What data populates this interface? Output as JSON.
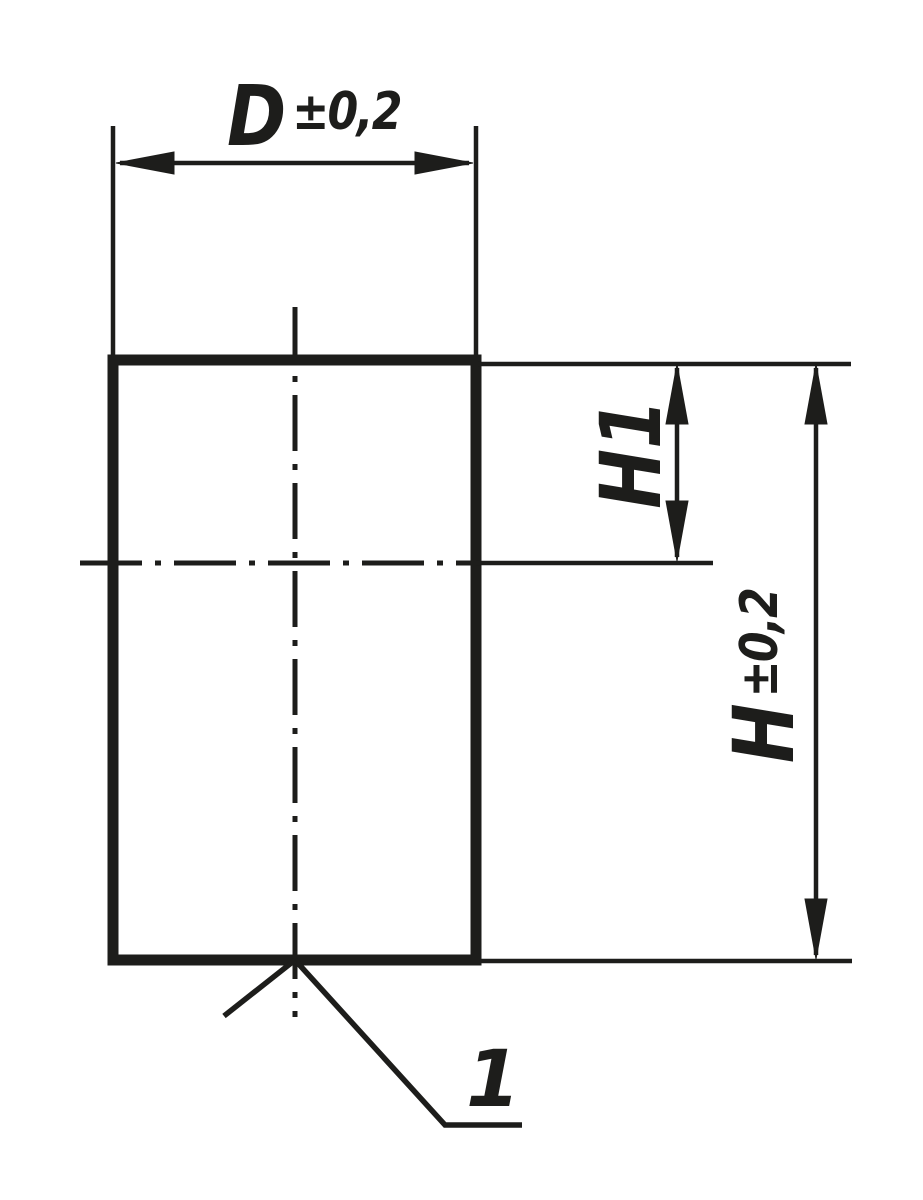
{
  "drawing": {
    "type": "technical-dimension-drawing",
    "background_color": "#ffffff",
    "line_color": "#1d1d1b",
    "dimensions": {
      "diameter": {
        "letter": "D",
        "tolerance": "±0,2"
      },
      "height_inner": {
        "label": "H1"
      },
      "height_overall": {
        "letter": "H",
        "tolerance": "±0,2"
      }
    },
    "callout": {
      "label": "1"
    }
  }
}
